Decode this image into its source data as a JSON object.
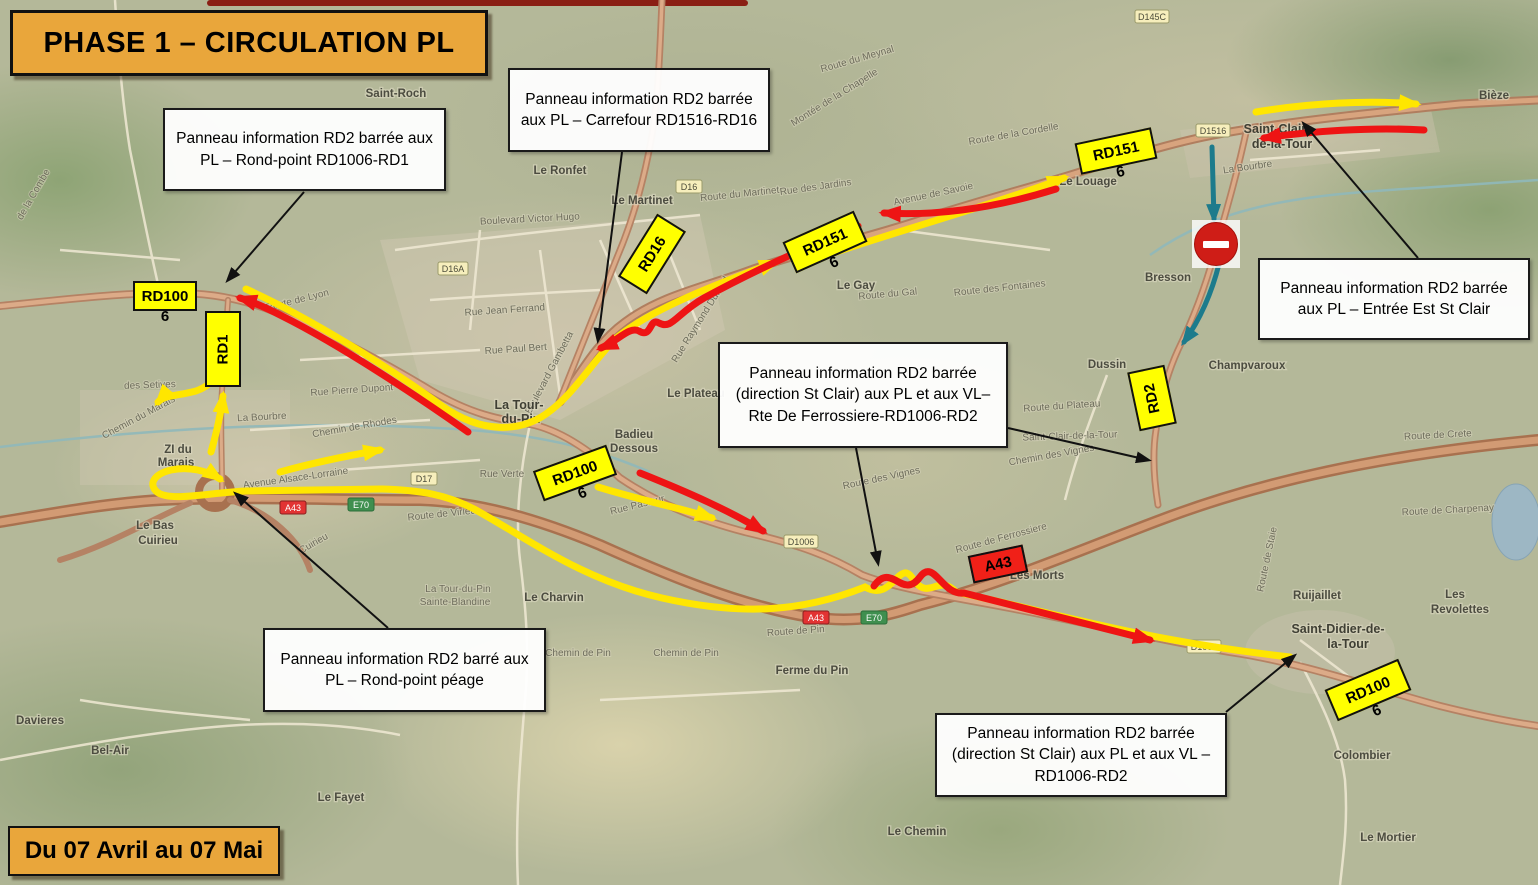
{
  "title_banner": {
    "text": "PHASE 1 – CIRCULATION PL"
  },
  "date_banner": {
    "text": "Du 07 Avril  au 07 Mai"
  },
  "colors": {
    "banner_orange": "#E9A63B",
    "route_yellow": "#FFE600",
    "route_red": "#EE1414",
    "detour_teal": "#1D7B8C",
    "label_yellow": "#FFFF00",
    "label_red": "#F02018"
  },
  "callouts": [
    {
      "id": "rondpoint-rd1006-rd1",
      "text": "Panneau information RD2 barrée aux PL – Rond-point RD1006-RD1"
    },
    {
      "id": "carrefour-rd1516-rd16",
      "text": "Panneau information RD2 barrée aux PL – Carrefour RD1516-RD16"
    },
    {
      "id": "entree-est-st-clair",
      "text": "Panneau information RD2 barrée aux PL – Entrée Est St Clair"
    },
    {
      "id": "rte-de-ferrossiere",
      "text": "Panneau information RD2 barrée (direction St Clair) aux PL et aux VL–  Rte De Ferrossiere-RD1006-RD2"
    },
    {
      "id": "rondpoint-peage",
      "text": "Panneau information RD2 barré aux PL – Rond-point péage"
    },
    {
      "id": "rd1006-rd2",
      "text": "Panneau information RD2 barrée (direction St Clair) aux PL et aux VL –  RD1006-RD2"
    }
  ],
  "road_labels": [
    {
      "name": "rd1006-west",
      "line1": "RD100",
      "line2": "6"
    },
    {
      "name": "rd1",
      "line1": "RD1",
      "line2": ""
    },
    {
      "name": "rd16",
      "line1": "RD16",
      "line2": ""
    },
    {
      "name": "rd1516-mid",
      "line1": "RD151",
      "line2": "6"
    },
    {
      "name": "rd1516-east",
      "line1": "RD151",
      "line2": "6"
    },
    {
      "name": "rd2",
      "line1": "RD2",
      "line2": ""
    },
    {
      "name": "rd1006-mid",
      "line1": "RD100",
      "line2": "6"
    },
    {
      "name": "rd1006-southeast",
      "line1": "RD100",
      "line2": "6"
    },
    {
      "name": "a43",
      "line1": "A43",
      "line2": ""
    }
  ],
  "map": {
    "places": [
      {
        "name": "saint-roch",
        "line1": "Saint-Roch",
        "line2": ""
      },
      {
        "name": "le-ronfet",
        "line1": "Le Ronfet",
        "line2": ""
      },
      {
        "name": "le-martinet",
        "line1": "Le Martinet",
        "line2": ""
      },
      {
        "name": "le-gay",
        "line1": "Le Gay",
        "line2": ""
      },
      {
        "name": "le-louage",
        "line1": "Le Louage",
        "line2": ""
      },
      {
        "name": "bresson",
        "line1": "Bresson",
        "line2": ""
      },
      {
        "name": "dussin",
        "line1": "Dussin",
        "line2": ""
      },
      {
        "name": "champvaroux",
        "line1": "Champvaroux",
        "line2": ""
      },
      {
        "name": "saint-clair-de-la-tour",
        "line1": "Saint-Clair-",
        "line2": "de-la-Tour"
      },
      {
        "name": "bieze",
        "line1": "Bièze",
        "line2": ""
      },
      {
        "name": "la-tour-du-pin",
        "line1": "La Tour-",
        "line2": "du-Pin"
      },
      {
        "name": "badieu-dessous",
        "line1": "Badieu",
        "line2": "Dessous"
      },
      {
        "name": "le-plateau",
        "line1": "Le Plateau",
        "line2": ""
      },
      {
        "name": "le-bas-cuirieu",
        "line1": "Le Bas",
        "line2": "Cuirieu"
      },
      {
        "name": "le-charvin",
        "line1": "Le Charvin",
        "line2": ""
      },
      {
        "name": "ferme-du-pin",
        "line1": "Ferme du Pin",
        "line2": ""
      },
      {
        "name": "le-chemin",
        "line1": "Le Chemin",
        "line2": ""
      },
      {
        "name": "le-fayet",
        "line1": "Le Fayet",
        "line2": ""
      },
      {
        "name": "bel-air",
        "line1": "Bel-Air",
        "line2": ""
      },
      {
        "name": "davieres",
        "line1": "Davieres",
        "line2": ""
      },
      {
        "name": "les-morts",
        "line1": "Les Morts",
        "line2": ""
      },
      {
        "name": "ruijaillet",
        "line1": "Ruijaillet",
        "line2": ""
      },
      {
        "name": "saint-didier-de-la-tour",
        "line1": "Saint-Didier-de-",
        "line2": "la-Tour"
      },
      {
        "name": "les-revolettes",
        "line1": "Les",
        "line2": "Revolettes"
      },
      {
        "name": "colombier",
        "line1": "Colombier",
        "line2": ""
      },
      {
        "name": "le-mortier",
        "line1": "Le Mortier",
        "line2": ""
      },
      {
        "name": "zi-du-marais",
        "line1": "ZI du",
        "line2": "Marais"
      }
    ],
    "streets": [
      {
        "label": "Route de Lyon"
      },
      {
        "label": "Rue Pierre Dupont"
      },
      {
        "label": "Chemin de Rhodes"
      },
      {
        "label": "Avenue Alsace-Lorraine"
      },
      {
        "label": "des Setives"
      },
      {
        "label": "Rue Verte"
      },
      {
        "label": "Rue Pasteur"
      },
      {
        "label": "Boulevard Gambetta"
      },
      {
        "label": "Rue Paul Bert"
      },
      {
        "label": "Route de Ferrossiere"
      },
      {
        "label": "Route de Pin"
      },
      {
        "label": "Chemin de Pin"
      },
      {
        "label": "Chemin de Pin"
      },
      {
        "label": "Route du Plateau"
      },
      {
        "label": "Route des Fontaines"
      },
      {
        "label": "Route des Vignes"
      },
      {
        "label": "La Bourbre"
      },
      {
        "label": "La Bourbre"
      },
      {
        "label": "Route du Martinet"
      },
      {
        "label": "Rue Raymond Durand"
      },
      {
        "label": "Rue des Jardins"
      },
      {
        "label": "Avenue de Savoie"
      },
      {
        "label": "Route de la Cordelle"
      },
      {
        "label": "Route de Crete"
      },
      {
        "label": "Route de Charpenay"
      },
      {
        "label": "Chemin du Marais"
      },
      {
        "label": "Route du Gal"
      },
      {
        "label": "Chemin des Vignes"
      },
      {
        "label": "Saint-Clair-de-la-Tour"
      },
      {
        "label": "Route de Virieu"
      },
      {
        "label": "Montée de la Chapelle"
      },
      {
        "label": "Route du Meynal"
      },
      {
        "label": "de la Combe"
      },
      {
        "label": "Cuirieu"
      },
      {
        "label": "La Tour-du-Pin"
      },
      {
        "label": "Sainte-Blandine"
      },
      {
        "label": "Rue Jean Ferrand"
      },
      {
        "label": "Boulevard Victor Hugo"
      },
      {
        "label": "Route de Staie"
      }
    ],
    "shields": [
      {
        "text": "D145C"
      },
      {
        "text": "D1516"
      },
      {
        "text": "D16A"
      },
      {
        "text": "D16"
      },
      {
        "text": "D17"
      },
      {
        "text": "A43"
      },
      {
        "text": "E70"
      },
      {
        "text": "A43"
      },
      {
        "text": "E70"
      },
      {
        "text": "D1006"
      },
      {
        "text": "D1006"
      }
    ]
  }
}
